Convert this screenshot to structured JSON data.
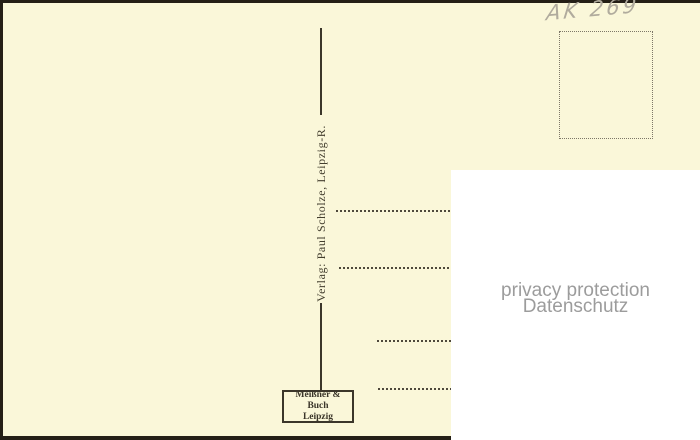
{
  "postcard_back": {
    "handwritten_note": "AK 269",
    "publisher_spine_text": "Verlag: Paul Scholze, Leipzig-R.",
    "printer_box": {
      "line1": "Meißner & Buch",
      "line2": "Leipzig"
    }
  },
  "privacy_overlay": {
    "line1": "privacy protection",
    "line2": "Datenschutz"
  },
  "colors": {
    "paper": "#faf7d9",
    "ink": "#3b362a",
    "stamp_box_dots": "#7d7768",
    "pencil": "#b0ab9d",
    "overlay_background": "#ffffff",
    "privacy_text": "#9c9c9c",
    "photo_edge": "#241f16"
  }
}
